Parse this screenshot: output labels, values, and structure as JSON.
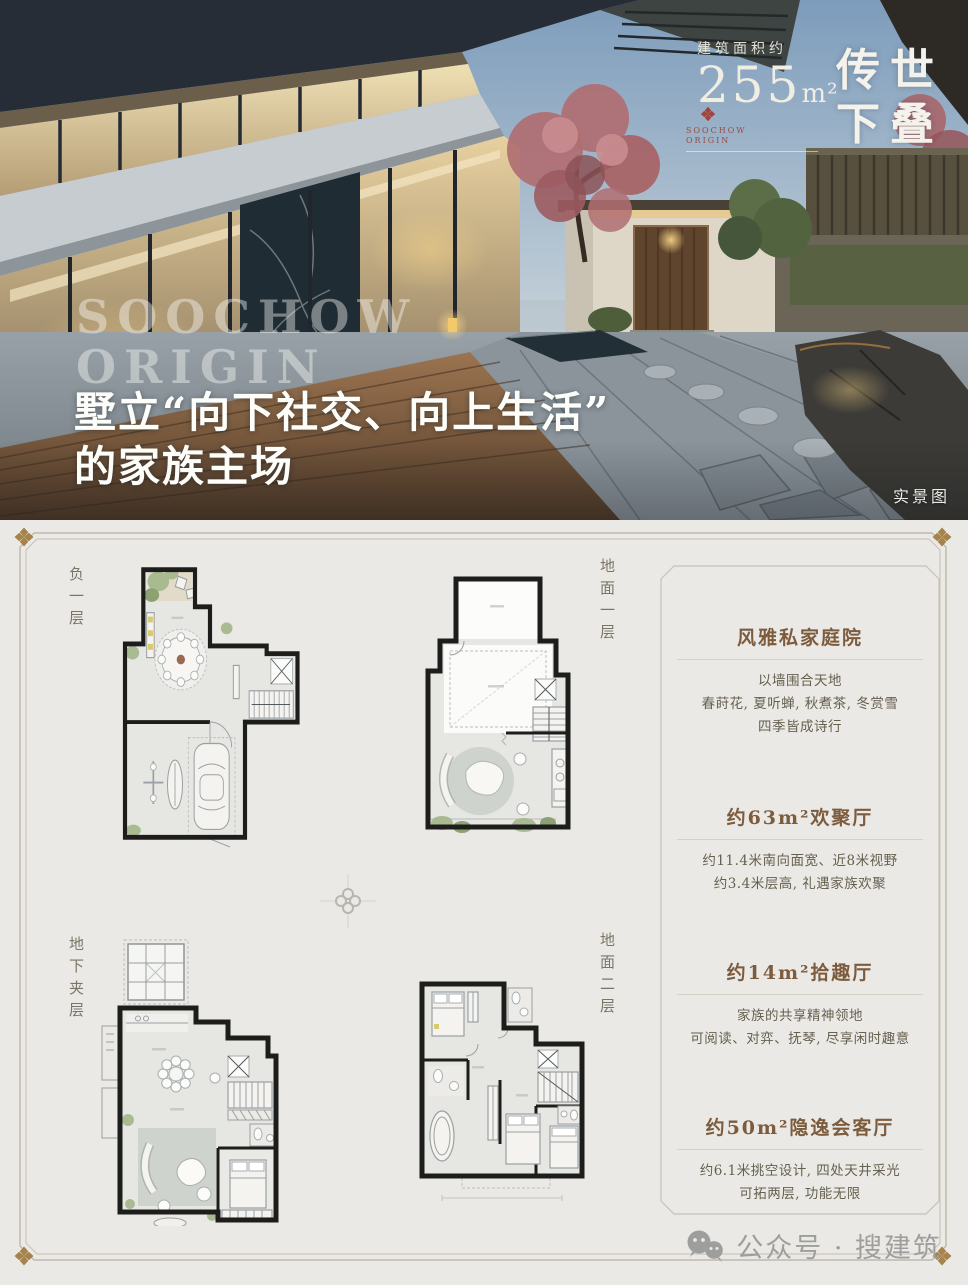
{
  "hero": {
    "area_label": "建筑面积约",
    "area_value": "255",
    "area_unit": "m²",
    "product_line1": "传世",
    "product_line2": "下叠",
    "brand_line1": "SOOCHOW",
    "brand_line2": "ORIGIN",
    "watermark_line1": "SOOCHOW",
    "watermark_line2": "ORIGIN",
    "headline_line1": "墅立“向下社交、向上生活”",
    "headline_line2": "的家族主场",
    "photo_tag": "实景图",
    "emblem_color": "#a2443d"
  },
  "plans": {
    "plan1_label": "负一层",
    "plan2_label": "地面一层",
    "plan3_label": "地下夹层",
    "plan4_label": "地面二层"
  },
  "info_panel": {
    "title_color": "#7d5c3e",
    "sections": [
      {
        "title": "风雅私家庭院",
        "lines": [
          "以墙围合天地",
          "春莳花, 夏听蝉, 秋煮茶, 冬赏雪",
          "四季皆成诗行"
        ]
      },
      {
        "title": "约63m²欢聚厅",
        "lines": [
          "约11.4米南向面宽、近8米视野",
          "约3.4米层高, 礼遇家族欢聚"
        ]
      },
      {
        "title": "约14m²拾趣厅",
        "lines": [
          "家族的共享精神领地",
          "可阅读、对弈、抚琴, 尽享闲时趣意"
        ]
      },
      {
        "title": "约50m²隐逸会客厅",
        "lines": [
          "约6.1米挑空设计, 四处天井采光",
          "可拓两层, 功能无限"
        ]
      }
    ]
  },
  "footer": {
    "wechat_label": "公众号 · 搜建筑"
  },
  "frame": {
    "ornament_color": "#a5834a"
  }
}
